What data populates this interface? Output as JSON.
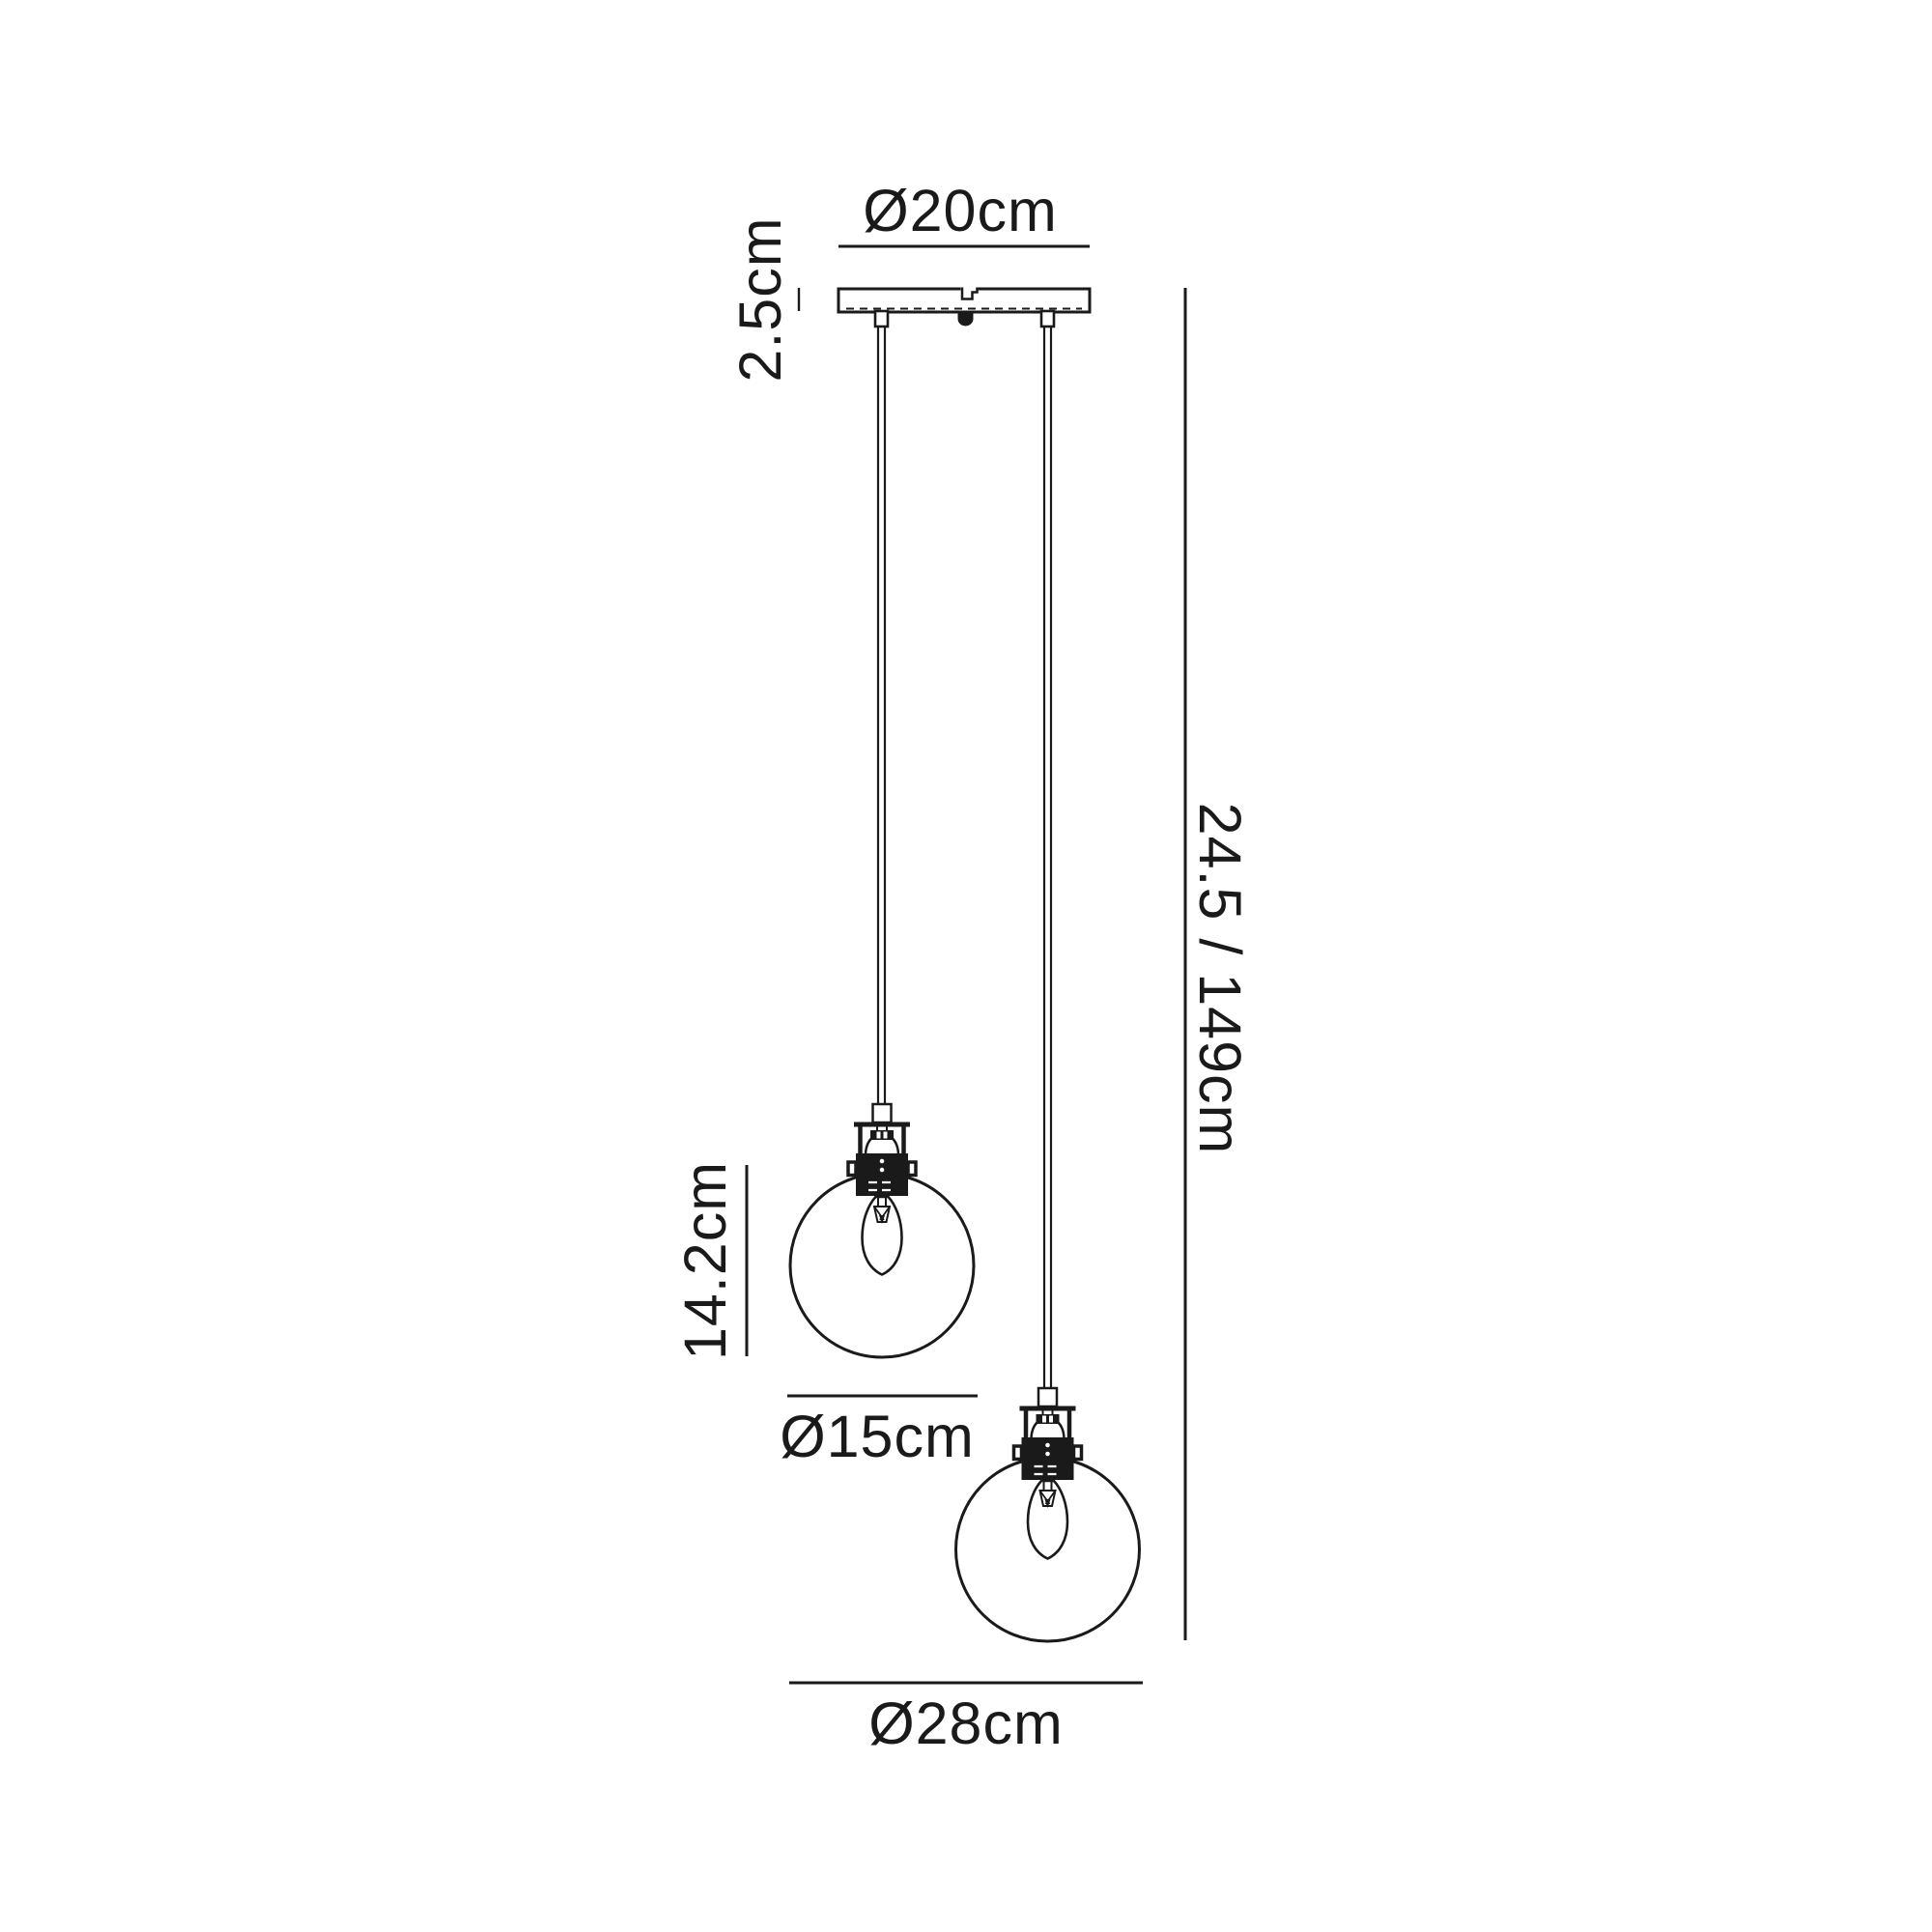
{
  "diagram": {
    "title_note": "",
    "labels": {
      "canopy_diameter": "Ø20cm",
      "canopy_height": "2.5cm",
      "overall_drop": "24.5 / 149cm",
      "shade_height": "14.2cm",
      "shade_diameter": "Ø15cm",
      "overall_spread": "Ø28cm"
    },
    "colors": {
      "line": "#1a1a1a",
      "background": "#ffffff"
    }
  }
}
